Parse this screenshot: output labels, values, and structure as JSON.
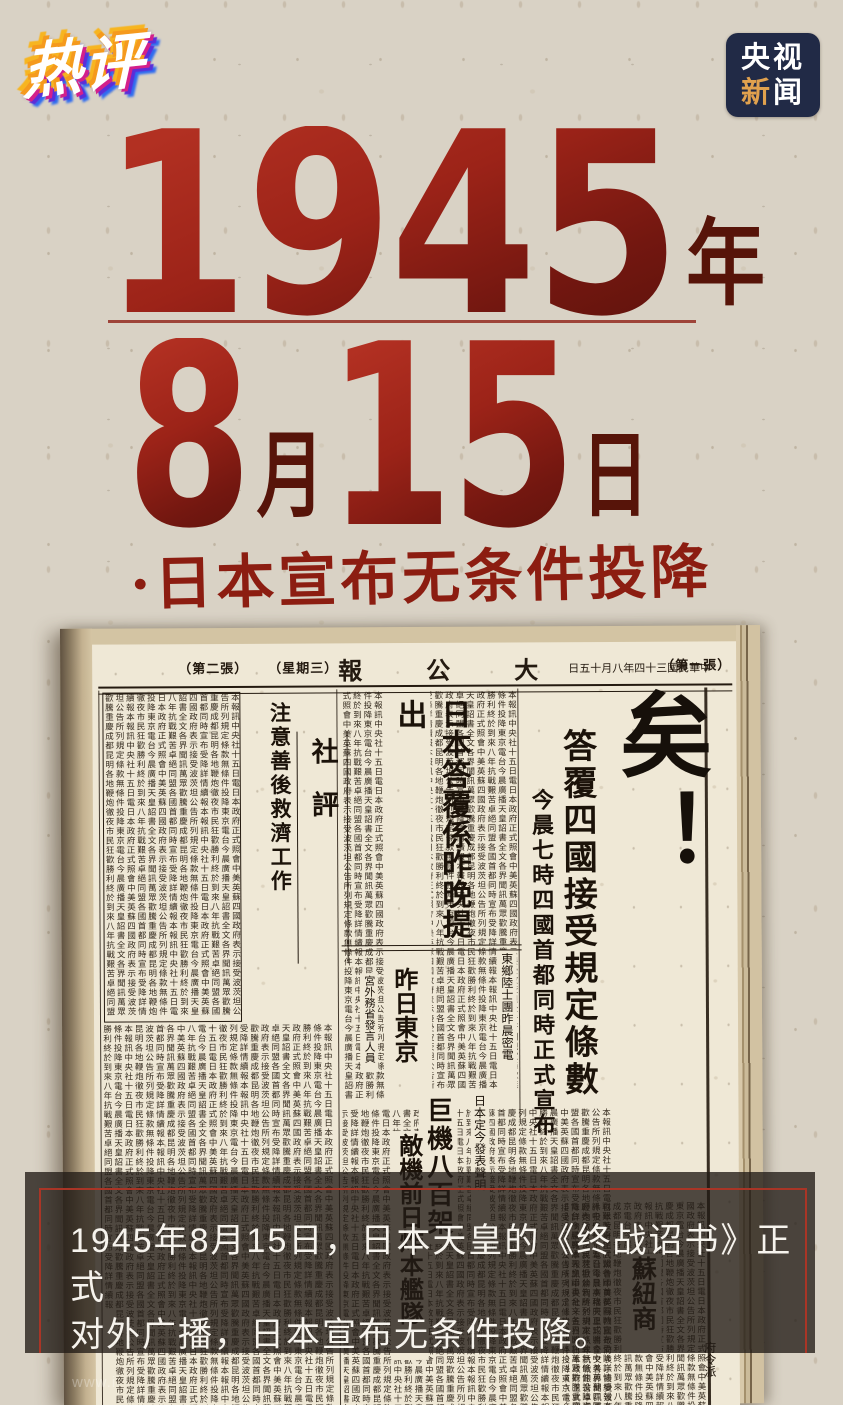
{
  "branding": {
    "logo_text": "热评",
    "badge": {
      "line1": "央视",
      "line2_char1": "新",
      "line2_char2": "闻",
      "bg_color": "#212a46",
      "accent_color": "#e0a14e"
    }
  },
  "headline": {
    "year_number": "1945",
    "year_suffix": "年",
    "month_number": "8",
    "month_suffix": "月",
    "day_number": "15",
    "day_suffix": "日",
    "subtitle": "·日本宣布无条件投降",
    "red_color": "#9c2318",
    "dark_red_color": "#571409"
  },
  "newspaper": {
    "masthead_left1": "（第二張）",
    "masthead_left2": "（星期三）",
    "masthead_title": "報公大",
    "masthead_date": "日五十月八年四十三國民華中",
    "masthead_right": "（第一張）",
    "main_headline": "日本投降矣！",
    "subhead1": "答覆四國接受規定條數",
    "subhead2": "今晨七時四國首都同時正式宣布",
    "editorial_label": "社評",
    "editorial_headline": "注意善後救濟工作",
    "mid_headline": "日本答覆係昨晚提出",
    "mid_subhead": "昨日東京",
    "mid_small": "宮外務省發言人員",
    "wire_small": "東鄉陸士團昨晨密電",
    "bottom_headline1": "巨機八百架",
    "bottom_headline2": "敵機前日炸本艦隊",
    "bottom_small": "日本定今發表聲明",
    "bottom_right_headline": "蘇紐商",
    "bottom_right_small": "府令派",
    "filler": "本報訊中央社十五日電日本政府正式照會中美英蘇四國政府表示接受波茨坦公告所列規定條款無條件投降東京電台今晨廣播天皇詔書全文各界聞訊萬眾歡騰重慶成都昆明各地鞭炮徹夜市民狂歡勝利終於到來八年抗戰艱苦卓絕同盟各國首都同時宣布受降詳情續報"
  },
  "caption": {
    "line1": "1945年8月15日，日本天皇的《终战诏书》正式",
    "line2": "对外广播，日本宣布无条件投降。",
    "border_color": "#a93526"
  },
  "watermark": "www.i"
}
